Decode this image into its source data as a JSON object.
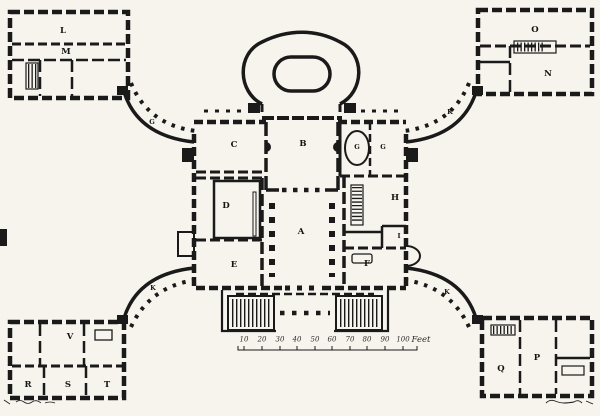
{
  "colors": {
    "ink": "#1a1a1a",
    "paper": "#f6f4ed"
  },
  "room_labels": [
    {
      "room": "northwest-pavilion-hall",
      "label": "L"
    },
    {
      "room": "northwest-pavilion-corridor",
      "label": "M"
    },
    {
      "room": "northeast-pavilion-hall",
      "label": "O"
    },
    {
      "room": "northeast-pavilion-room",
      "label": "N"
    },
    {
      "room": "northwest-quadrant-corridor",
      "label": "G"
    },
    {
      "room": "northeast-quadrant-corridor",
      "label": "K"
    },
    {
      "room": "southwest-quadrant-corridor",
      "label": "K"
    },
    {
      "room": "southeast-quadrant-corridor",
      "label": "K"
    },
    {
      "room": "north-west-room",
      "label": "C"
    },
    {
      "room": "north-centre-hall",
      "label": "B"
    },
    {
      "room": "north-east-small-room-1",
      "label": "G"
    },
    {
      "room": "north-east-small-room-2",
      "label": "G"
    },
    {
      "room": "west-great-room",
      "label": "D"
    },
    {
      "room": "east-room",
      "label": "H"
    },
    {
      "room": "central-columned-hall",
      "label": "A"
    },
    {
      "room": "east-small-room",
      "label": "I"
    },
    {
      "room": "south-west-room",
      "label": "E"
    },
    {
      "room": "south-east-room",
      "label": "F"
    },
    {
      "room": "southwest-pavilion-upper-room",
      "label": "V"
    },
    {
      "room": "southwest-pavilion-room-1",
      "label": "R"
    },
    {
      "room": "southwest-pavilion-room-2",
      "label": "S"
    },
    {
      "room": "southwest-pavilion-room-3",
      "label": "T"
    },
    {
      "room": "southeast-pavilion-room-1",
      "label": "Q"
    },
    {
      "room": "southeast-pavilion-room-2",
      "label": "P"
    }
  ],
  "scale_bar": {
    "ticks": [
      "10",
      "20",
      "30",
      "40",
      "50",
      "60",
      "70",
      "80",
      "90",
      "100"
    ],
    "unit": "Feet"
  }
}
